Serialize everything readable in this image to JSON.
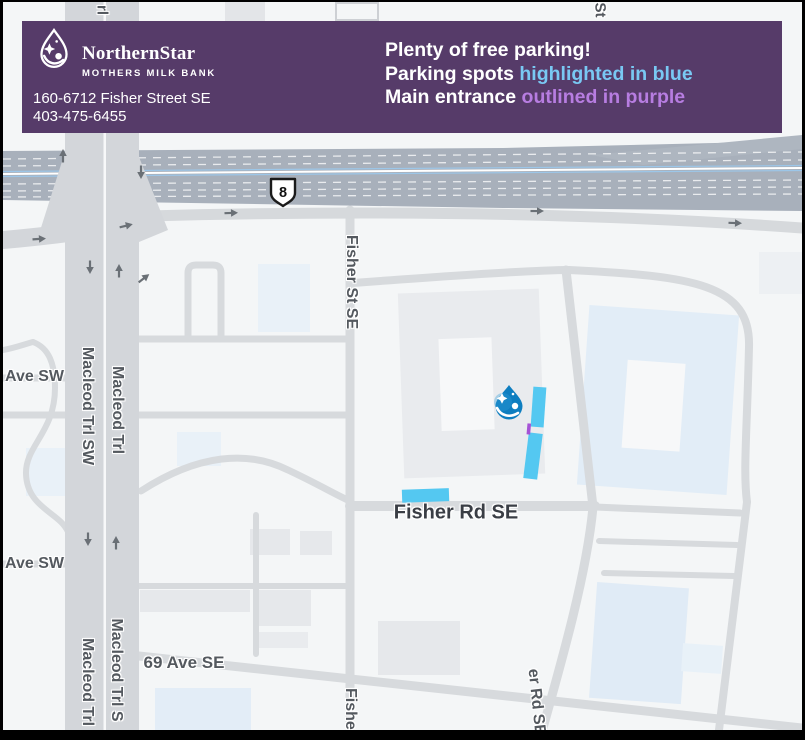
{
  "banner": {
    "logo": {
      "name": "NorthernStar",
      "subtitle": "MOTHERS MILK BANK"
    },
    "address_line1": "160-6712 Fisher Street SE",
    "address_line2": "403-475-6455",
    "headline": "Plenty of free parking!",
    "line2_prefix": "Parking spots ",
    "line2_highlight": "highlighted in blue",
    "line3_prefix": "Main entrance ",
    "line3_highlight": "outlined in purple",
    "colors": {
      "background": "#563b69",
      "highlight_blue": "#79c8f3",
      "highlight_purple": "#b77de1"
    }
  },
  "map": {
    "highway_shield_number": "8",
    "labels": {
      "road_top_left": "rl",
      "road_top_right": "St",
      "fisher_st_se": "Fisher St SE",
      "macleod_trl_sw": "Macleod Trl SW",
      "macleod_trl_upper": "Macleod Trl",
      "macleod_trl_lower": "Macleod Trl",
      "macleod_trl_s": "Macleod Trl S",
      "ave_sw_upper": "Ave SW",
      "ave_sw_lower": "Ave SW",
      "ave_69_se": "69 Ave SE",
      "fisher_rd_se": "Fisher Rd SE",
      "fisher_partial_bottom": "Fisher",
      "fisher_rd_se_partial": "er Rd SE"
    },
    "annotations": {
      "parking_highlight_color": "#54c8f1",
      "entrance_outline_color": "#a553d6",
      "marker_color": "#0e7ec0"
    }
  }
}
